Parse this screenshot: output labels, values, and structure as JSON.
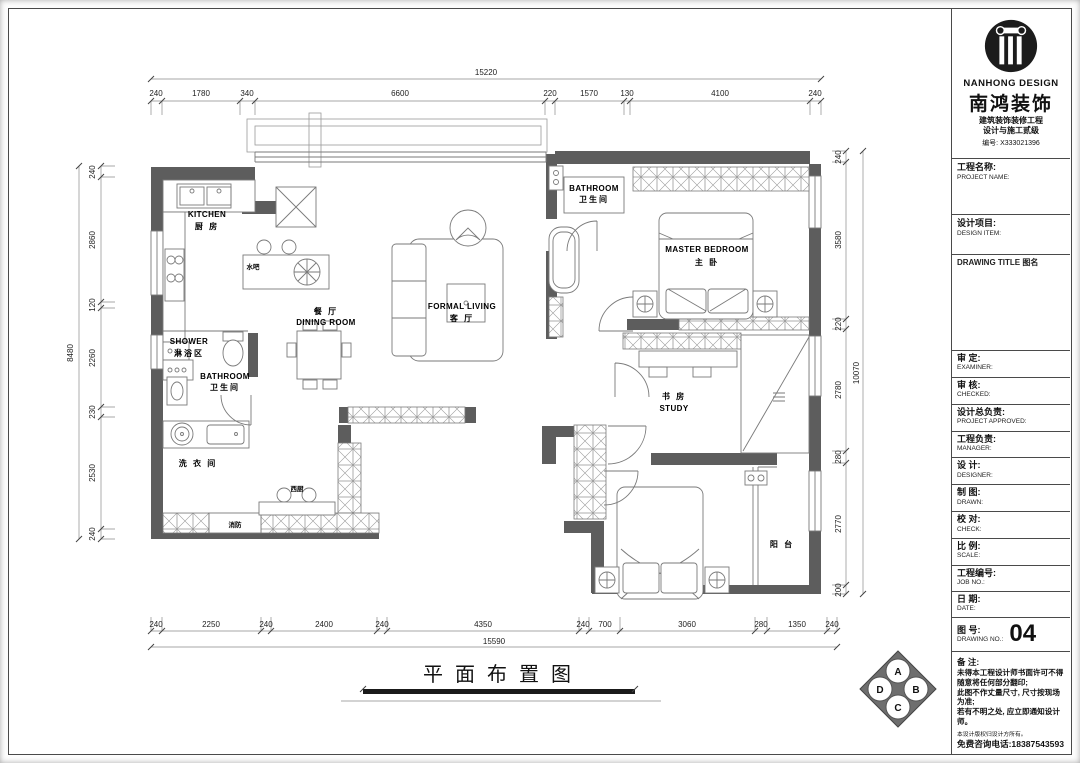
{
  "brand": {
    "en_name": "NANHONG DESIGN",
    "cn_name": "南鸿装饰",
    "cert_line1": "建筑装饰装修工程",
    "cert_line2": "设计与施工贰级",
    "serial": "编号: X333021396"
  },
  "fields": {
    "project_name": {
      "cn": "工程名称:",
      "en": "PROJECT NAME:"
    },
    "design_item": {
      "cn": "设计项目:",
      "en": "DESIGN ITEM:"
    },
    "drawing_title_label": "DRAWING TITLE 图名",
    "examiner": {
      "cn": "审  定:",
      "en": "EXAMINER:"
    },
    "checked": {
      "cn": "审  核:",
      "en": "CHECKED:"
    },
    "project_approved": {
      "cn": "设计总负责:",
      "en": "PROJECT APPROVED:"
    },
    "manager": {
      "cn": "工程负责:",
      "en": "MANAGER:"
    },
    "designer": {
      "cn": "设  计:",
      "en": "DESIGNER:"
    },
    "drawn": {
      "cn": "制  图:",
      "en": "DRAWN:"
    },
    "check": {
      "cn": "校  对:",
      "en": "CHECK:"
    },
    "scale": {
      "cn": "比  例:",
      "en": "SCALE:"
    },
    "job_no": {
      "cn": "工程编号:",
      "en": "JOB NO.:"
    },
    "date": {
      "cn": "日  期:",
      "en": "DATE:"
    },
    "drawing_no": {
      "cn": "图  号:",
      "en": "DRAWING NO.:",
      "value": "04"
    }
  },
  "remarks": {
    "title": "备  注:",
    "lines": [
      "未得本工程设计师书面许可不得",
      "随意将任何部分翻印;",
      "此图不作丈量尺寸, 尺寸按现场",
      "为准;",
      "若有不明之处, 应立即通知设计",
      "师。"
    ],
    "fine_print": "本设计版权归设计方所有。",
    "phone": "免费咨询电话:18387543593"
  },
  "plan": {
    "sheet_title": "平面布置图",
    "rooms": {
      "kitchen": {
        "en": "KITCHEN",
        "cn": "厨 房"
      },
      "bar": {
        "cn": "水吧"
      },
      "dining": {
        "cn": "餐 厅",
        "en": "DINING ROOM"
      },
      "living": {
        "en": "FORMAL LIVING",
        "cn": "客 厅"
      },
      "bathroom_top": {
        "en": "BATHROOM",
        "cn": "卫生间"
      },
      "master": {
        "en": "MASTER BEDROOM",
        "cn": "主 卧"
      },
      "study": {
        "cn": "书 房",
        "en": "STUDY"
      },
      "balcony": {
        "cn": "阳 台"
      },
      "shower": {
        "en": "SHOWER",
        "cn": "淋浴区"
      },
      "bathroom_bottom": {
        "en": "BATHROOM",
        "cn": "卫生间"
      },
      "laundry": {
        "cn": "洗 衣 间"
      },
      "fire": {
        "cn": "消防"
      },
      "west_kitchen": {
        "cn": "西厨"
      }
    },
    "dims": {
      "top": {
        "total": "15220",
        "segments": [
          "240",
          "1780",
          "340",
          "6600",
          "220",
          "1570",
          "130",
          "4100",
          "240"
        ]
      },
      "bottom": {
        "total": "15590",
        "segments": [
          "240",
          "2250",
          "240",
          "2400",
          "240",
          "4350",
          "240",
          "700",
          "3060",
          "280",
          "1350",
          "240"
        ]
      },
      "left": {
        "total": "8480",
        "segments": [
          "240",
          "2860",
          "120",
          "2260",
          "230",
          "2530",
          "240"
        ]
      },
      "right": {
        "total": "10070",
        "segments": [
          "240",
          "3580",
          "220",
          "2780",
          "280",
          "2770",
          "200"
        ]
      }
    },
    "compass": {
      "a": "A",
      "b": "B",
      "c": "C",
      "d": "D"
    }
  }
}
